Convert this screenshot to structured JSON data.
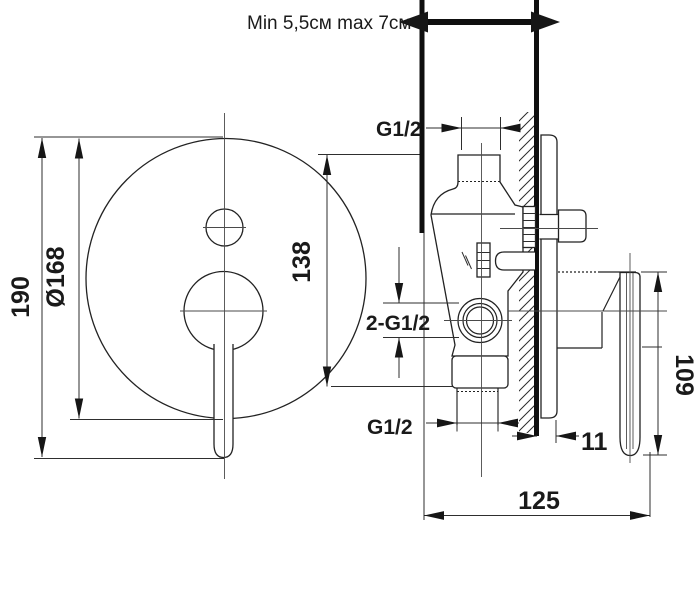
{
  "note": {
    "wall_depth_range": "Min 5,5см max 7см"
  },
  "front_view": {
    "overall_height": "190",
    "plate_diameter": "Ø168",
    "port_span": "138"
  },
  "side_view": {
    "top_thread": "G1/2",
    "front_threads": "2-G1/2",
    "bottom_thread": "G1/2",
    "plate_protrusion": "11",
    "rough_in_depth": "125",
    "handle_length": "109"
  },
  "colors": {
    "ink": "#1a1a1a",
    "object_line": "#222222",
    "centerline": "#4a4a4a",
    "background": "#ffffff"
  }
}
